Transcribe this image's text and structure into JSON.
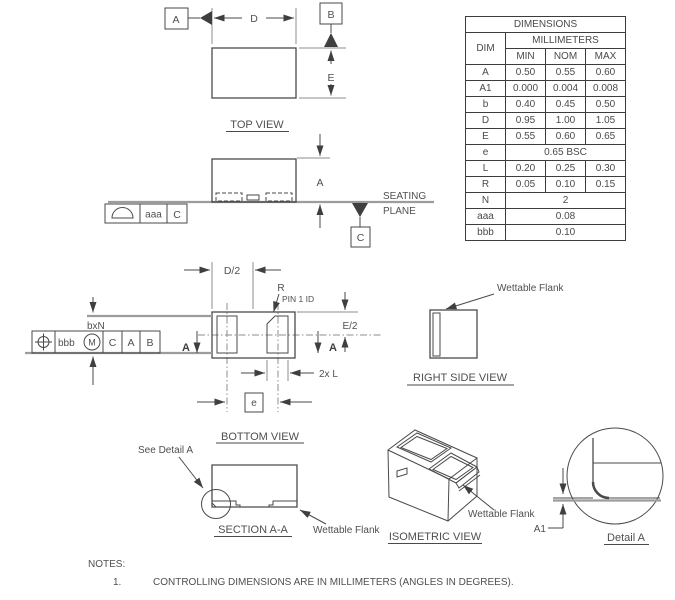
{
  "table": {
    "title": "DIMENSIONS",
    "dim_header": "DIM",
    "unit_header": "MILLIMETERS",
    "col_headers": [
      "MIN",
      "NOM",
      "MAX"
    ],
    "rows": [
      {
        "dim": "A",
        "min": "0.50",
        "nom": "0.55",
        "max": "0.60"
      },
      {
        "dim": "A1",
        "min": "0.000",
        "nom": "0.004",
        "max": "0.008"
      },
      {
        "dim": "b",
        "min": "0.40",
        "nom": "0.45",
        "max": "0.50"
      },
      {
        "dim": "D",
        "min": "0.95",
        "nom": "1.00",
        "max": "1.05"
      },
      {
        "dim": "E",
        "min": "0.55",
        "nom": "0.60",
        "max": "0.65"
      },
      {
        "dim": "e",
        "span": "0.65 BSC"
      },
      {
        "dim": "L",
        "min": "0.20",
        "nom": "0.25",
        "max": "0.30"
      },
      {
        "dim": "R",
        "min": "0.05",
        "nom": "0.10",
        "max": "0.15"
      },
      {
        "dim": "N",
        "span": "2"
      },
      {
        "dim": "aaa",
        "span": "0.08"
      },
      {
        "dim": "bbb",
        "span": "0.10"
      }
    ]
  },
  "views": {
    "top_label": "TOP VIEW",
    "bottom_label": "BOTTOM VIEW",
    "right_side_label": "RIGHT SIDE VIEW",
    "section_label": "SECTION A-A",
    "isometric_label": "ISOMETRIC VIEW",
    "detail_label": "Detail A"
  },
  "dims": {
    "d": "D",
    "e": "E",
    "a": "A",
    "a1": "A1",
    "d_half": "D/2",
    "e_half": "E/2",
    "r": "R",
    "two_x_l": "2x L",
    "pitch": "e",
    "bxn": "bxN"
  },
  "datums": {
    "a": "A",
    "b": "B",
    "c": "C"
  },
  "section_marker": "A",
  "fcf": {
    "profile": {
      "value": "aaa",
      "datum": "C"
    },
    "position": {
      "value": "bbb",
      "modifier": "M",
      "datum1": "C",
      "datum2": "A",
      "datum3": "B"
    }
  },
  "callouts": {
    "seating_1": "SEATING",
    "seating_2": "PLANE",
    "pin1_id": "PIN 1 ID",
    "see_detail": "See Detail A",
    "wettable_flank": "Wettable Flank"
  },
  "notes": {
    "heading": "NOTES:",
    "item1_num": "1.",
    "item1_text": "CONTROLLING DIMENSIONS ARE IN MILLIMETERS (ANGLES IN DEGREES)."
  }
}
